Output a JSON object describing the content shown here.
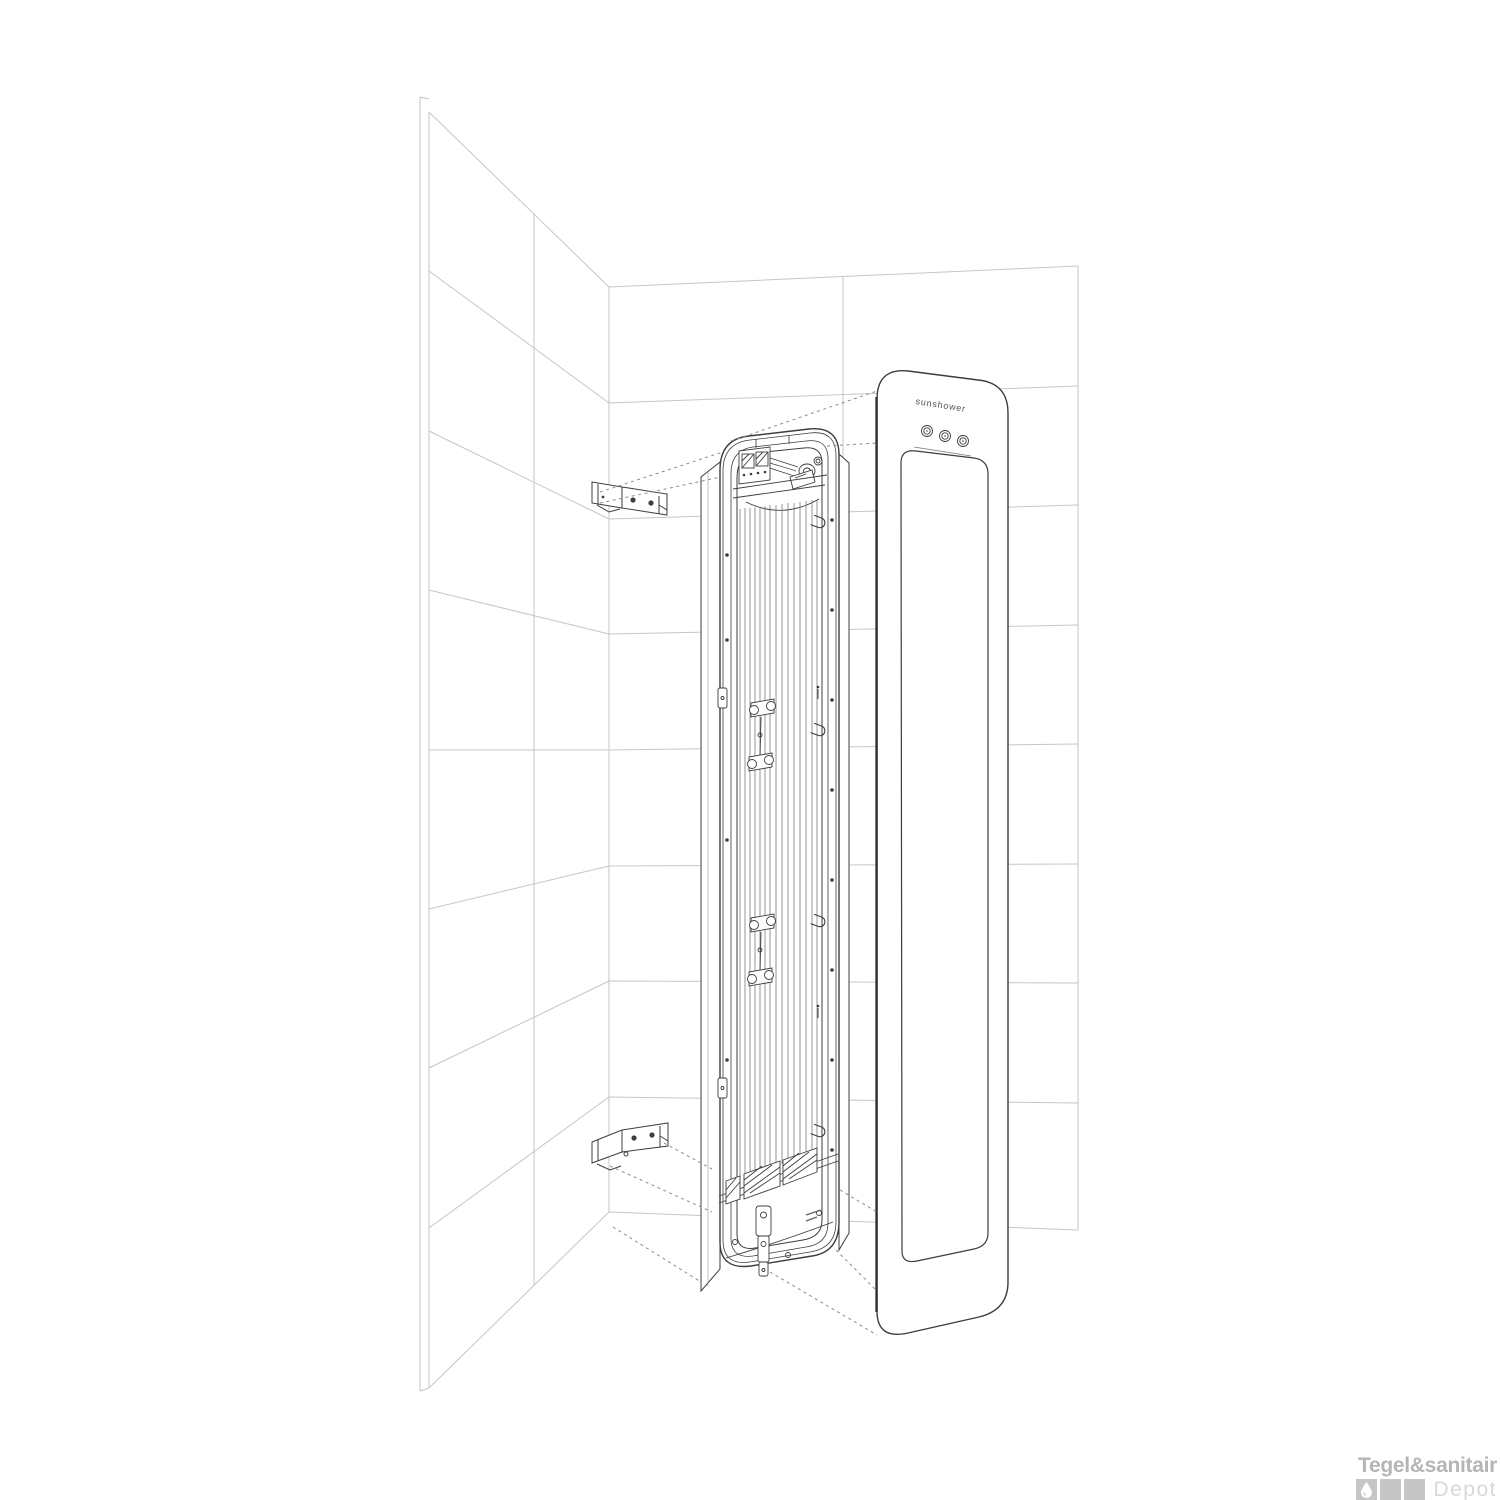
{
  "diagram": {
    "type": "exploded-installation-diagram",
    "subject": "recessed heating panel mounted in tiled shower corner",
    "panel": {
      "logo": "sunshower",
      "buttons": [
        "panel-button-left",
        "panel-button-center",
        "panel-button-right"
      ]
    },
    "colors": {
      "wall_line": "#c6c6c6",
      "product_line": "#3d3d3d",
      "dashed_line": "#8c8c8c",
      "background": "#ffffff"
    }
  },
  "watermark": {
    "brand": "Tegel&sanitair",
    "suffix": "Depot",
    "brand_color": "#b5b5b5",
    "suffix_color": "#d8d8d8",
    "square_color": "#c6c6c6",
    "squares": [
      "water-drop-icon",
      "blank-square",
      "blank-square"
    ]
  }
}
